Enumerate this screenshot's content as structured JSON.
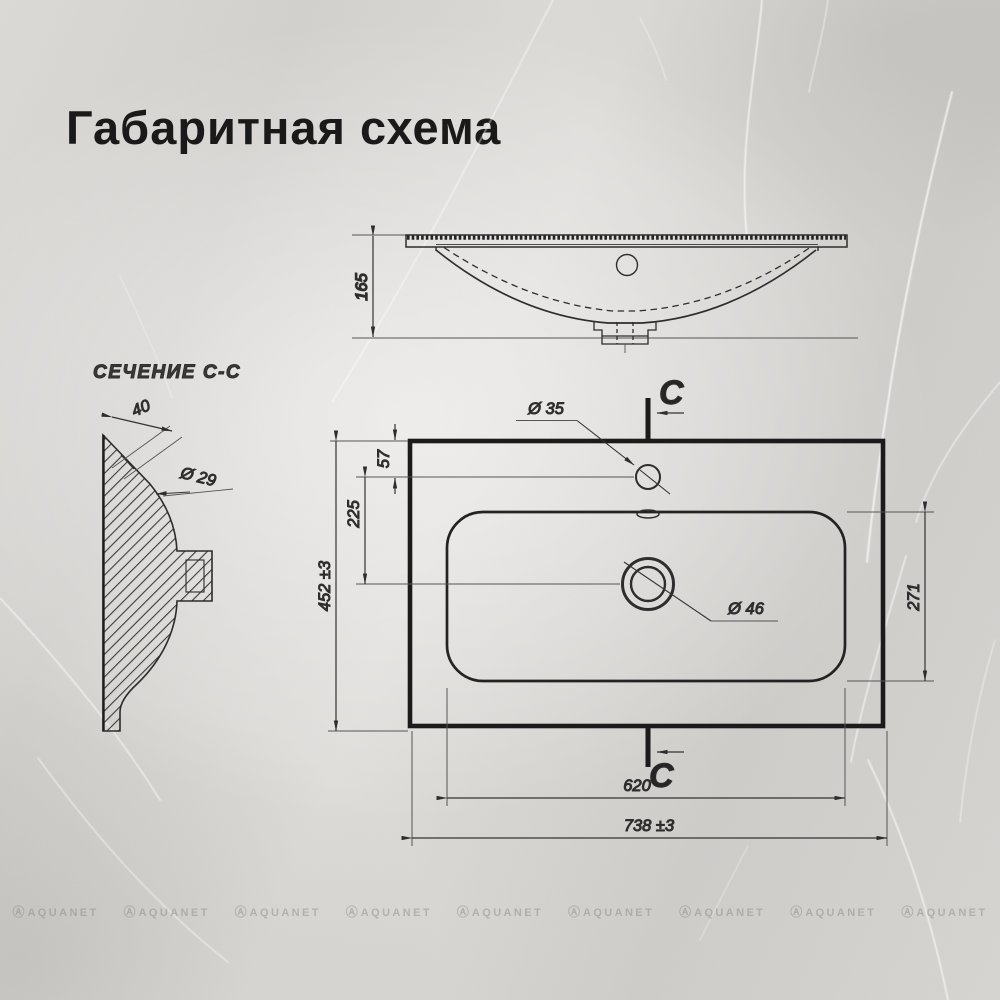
{
  "title": "Габаритная схема",
  "section_view": {
    "label": "СЕЧЕНИЕ С-С",
    "dim_deck_width": "40",
    "dim_hole_dia": "Ø 29"
  },
  "elevation_view": {
    "dim_height": "165"
  },
  "plan_view": {
    "marker_top": "C",
    "marker_bottom": "C",
    "dim_faucet_offset": "57",
    "dim_drain_offset": "225",
    "dim_overall_height": "452 ±3",
    "dim_basin_height": "271",
    "dim_faucet_dia": "Ø 35",
    "dim_drain_dia": "Ø 46",
    "dim_basin_width": "620",
    "dim_overall_width": "738 ±3"
  },
  "watermark": {
    "logo_glyph": "Ⓐ",
    "text": "AQUANET",
    "count": 9
  },
  "colors": {
    "ink": "#161616",
    "line_thick": "#1b1b1b",
    "line": "#2d2d2d",
    "line_thin": "#4a4a4a",
    "dim_text": "#333333",
    "background": "#d6d4d1"
  }
}
